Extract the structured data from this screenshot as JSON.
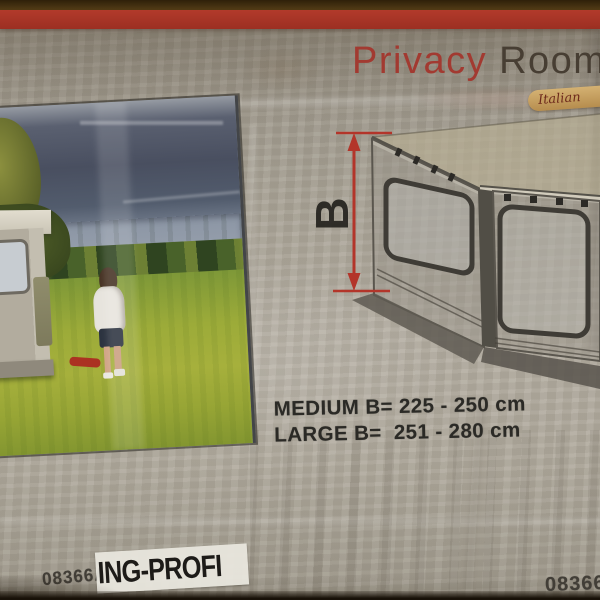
{
  "package": {
    "brand_title": {
      "word1": "Privacy",
      "word2": "Room"
    },
    "badge_text": "Italian",
    "diagram": {
      "dimension_label": "B"
    },
    "sizes": [
      {
        "label": "MEDIUM B= 225 - 250 cm"
      },
      {
        "label": "LARGE B=  251 - 280 cm"
      }
    ],
    "product_code_left": "08366A0",
    "retailer_sticker": "ING-PROFI",
    "product_code_right": "08366",
    "colors": {
      "stripe_red": "#a93327",
      "title_red": "#a23a31",
      "title_dark": "#473e33",
      "dimension_red": "#b3352a",
      "text_dark": "#2b2a26",
      "badge_gold": "#c9a567",
      "package_gray": "#a8a296",
      "grass_green": "#9cab39",
      "sky_slate": "#494f60"
    }
  }
}
